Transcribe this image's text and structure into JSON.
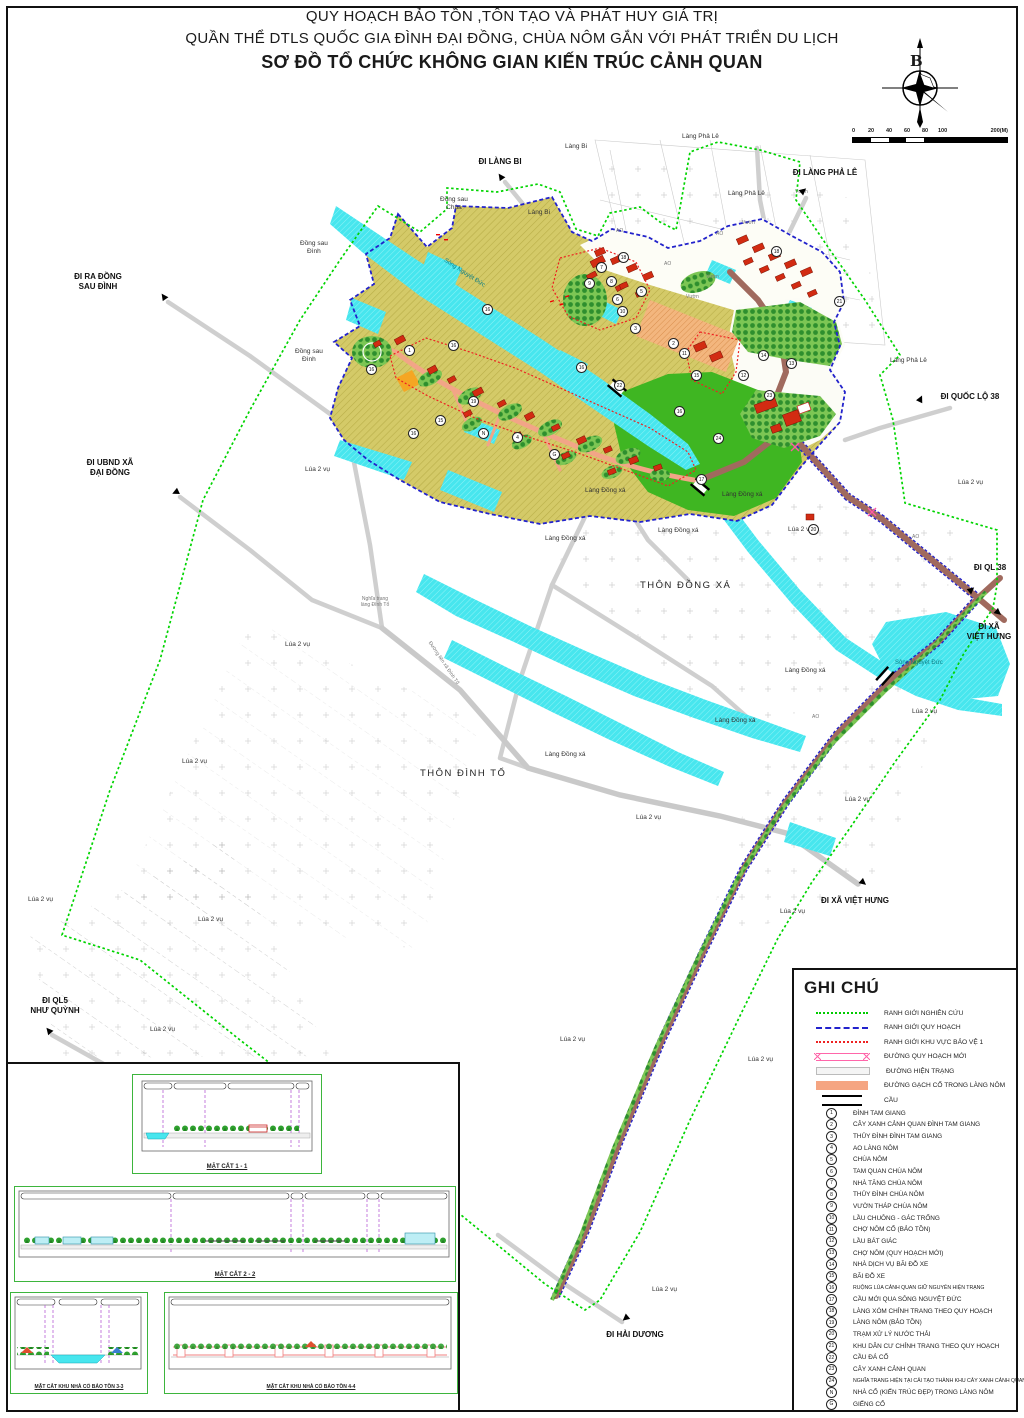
{
  "title": {
    "line1": "QUY HOẠCH BẢO TỒN ,TÔN TẠO VÀ PHÁT HUY GIÁ TRỊ",
    "line2": "QUẦN THỂ DTLS QUỐC GIA ĐÌNH ĐẠI ĐỒNG, CHÙA NÔM GẮN VỚI PHÁT TRIỂN DU LỊCH",
    "line3": "SƠ ĐỒ TỔ CHỨC KHÔNG GIAN KIẾN TRÚC CẢNH QUAN"
  },
  "compass": {
    "north_label": "B"
  },
  "scalebar": {
    "ticks": [
      "0",
      "20",
      "40",
      "60",
      "80",
      "100"
    ],
    "end_label": "200(M)"
  },
  "legend": {
    "title": "GHI CHÚ",
    "line_items": [
      {
        "label": "RANH GIỚI NGHIÊN CỨU"
      },
      {
        "label": "RANH GIỚI QUY HOẠCH"
      },
      {
        "label": "RANH GIỚI KHU VỰC BẢO VỆ 1"
      },
      {
        "label": "ĐƯỜNG QUY HOẠCH MỚI"
      },
      {
        "label": "ĐƯỜNG HIỆN TRẠNG"
      },
      {
        "label": "ĐƯỜNG GẠCH CỔ TRONG LÀNG NÔM"
      },
      {
        "label": "CẦU"
      }
    ],
    "numbered_items": [
      {
        "key": "1",
        "label": "ĐÌNH TAM GIANG"
      },
      {
        "key": "2",
        "label": "CÂY XANH CẢNH QUAN ĐÌNH TAM GIANG"
      },
      {
        "key": "3",
        "label": "THỦY ĐÌNH ĐÌNH TAM GIANG"
      },
      {
        "key": "4",
        "label": "AO LÀNG NÔM"
      },
      {
        "key": "5",
        "label": "CHÙA NÔM"
      },
      {
        "key": "6",
        "label": "TAM QUAN CHÙA NÔM"
      },
      {
        "key": "7",
        "label": "NHÀ TĂNG CHÙA NÔM"
      },
      {
        "key": "8",
        "label": "THỦY ĐÌNH CHÙA NÔM"
      },
      {
        "key": "9",
        "label": "VƯỜN THÁP CHÙA NÔM"
      },
      {
        "key": "10",
        "label": "LẦU CHUÔNG - GÁC TRỐNG"
      },
      {
        "key": "11",
        "label": "CHỢ NÔM CỔ (BẢO TỒN)"
      },
      {
        "key": "12",
        "label": "LẦU BÁT GIÁC"
      },
      {
        "key": "13",
        "label": "CHỢ NÔM (QUY HOẠCH MỚI)"
      },
      {
        "key": "14",
        "label": "NHÀ DỊCH VỤ BÃI ĐỖ XE"
      },
      {
        "key": "15",
        "label": "BÃI ĐỖ XE"
      },
      {
        "key": "16",
        "label": "RUỘNG LÚA CẢNH QUAN GIỮ NGUYÊN HIỆN TRẠNG"
      },
      {
        "key": "17",
        "label": "CẦU MỚI QUA SÔNG NGUYỆT ĐỨC"
      },
      {
        "key": "18",
        "label": "LÀNG XÓM CHỈNH TRANG THEO QUY HOẠCH"
      },
      {
        "key": "19",
        "label": "LÀNG NÔM (BẢO TỒN)"
      },
      {
        "key": "20",
        "label": "TRẠM XỬ LÝ NƯỚC THẢI"
      },
      {
        "key": "21",
        "label": "KHU DÂN CƯ CHỈNH TRANG THEO QUY HOẠCH"
      },
      {
        "key": "22",
        "label": "CẦU ĐÁ CỔ"
      },
      {
        "key": "23",
        "label": "CÂY XANH CẢNH QUAN"
      },
      {
        "key": "24",
        "label": "NGHĨA TRANG HIỆN TẠI CẢI TẠO THÀNH KHU CÂY XANH CẢNH QUAN"
      },
      {
        "key": "N",
        "label": "NHÀ CỔ (KIẾN TRÚC ĐẸP) TRONG LÀNG NÔM"
      },
      {
        "key": "G",
        "label": "GIẾNG CỔ"
      }
    ]
  },
  "sections": {
    "s1": "MẶT CẮT 1 - 1",
    "s2": "MẶT CẮT 2 - 2",
    "s3": "MẶT CẮT KHU NHÀ CỔ BẢO TỒN 3-3",
    "s4": "MẶT CẮT KHU NHÀ CỔ BẢO TỒN 4-4"
  },
  "map": {
    "colors": {
      "research_boundary": "#00d400",
      "planning_boundary": "#2222cc",
      "protection_boundary": "#ee2222",
      "water": "#47e6ee",
      "rice_field": "#d2c763",
      "new_road": "#a06a5e",
      "brick_road": "#f2a587",
      "green_field": "#3fb622"
    },
    "labels": [
      {
        "text": "ĐI LÀNG BI"
      },
      {
        "text": "ĐI LÀNG PHẢ LÊ"
      },
      {
        "text": "ĐI RA ĐỒNG\nSAU ĐÌNH"
      },
      {
        "text": "ĐI UBND XÃ\nĐẠI ĐỒNG"
      },
      {
        "text": "ĐI QUỐC LỘ 38"
      },
      {
        "text": "ĐI QL 38"
      },
      {
        "text": "ĐI XÃ\nVIỆT HƯNG"
      },
      {
        "text": "ĐI XÃ VIỆT HƯNG"
      },
      {
        "text": "ĐI QL5\nNHƯ QUỲNH"
      },
      {
        "text": "ĐI HẢI DƯƠNG"
      },
      {
        "text": "Làng Bi"
      },
      {
        "text": "Làng Phả Lê"
      },
      {
        "text": "Làng Phả Lê"
      },
      {
        "text": "Vườn"
      },
      {
        "text": "Đồng sau\nChùa"
      },
      {
        "text": "Làng Bi"
      },
      {
        "text": "Đồng sau\nĐình"
      },
      {
        "text": "Đồng sau\nĐình"
      },
      {
        "text": "Làng Phả Lê"
      },
      {
        "text": "AO"
      },
      {
        "text": "AO"
      },
      {
        "text": "AO"
      },
      {
        "text": "Vườn"
      },
      {
        "text": "Vườn"
      },
      {
        "text": "Vườn"
      },
      {
        "text": "Làng Đồng xá"
      },
      {
        "text": "Làng Đồng xá"
      },
      {
        "text": "Làng Đồng xá"
      },
      {
        "text": "Làng Đồng xá"
      },
      {
        "text": "Làng Đồng xá"
      },
      {
        "text": "Làng Đồng xá"
      },
      {
        "text": "Làng Đồng xá"
      },
      {
        "text": "THÔN ĐỒNG XÁ"
      },
      {
        "text": "THÔN ĐÌNH TỔ"
      },
      {
        "text": "Sông Nguyệt Đức"
      },
      {
        "text": "Sông Nguyệt Đức"
      },
      {
        "text": "Nghĩa trang\nlàng Đình Tổ"
      },
      {
        "text": "AO"
      },
      {
        "text": "AO"
      },
      {
        "text": "Lúa 2 vụ"
      },
      {
        "text": "Lúa 2 vụ"
      },
      {
        "text": "Lúa 2 vụ"
      },
      {
        "text": "Lúa 2 vụ"
      },
      {
        "text": "Lúa 2 vụ"
      },
      {
        "text": "Lúa 2 vụ"
      },
      {
        "text": "Lúa 2 vụ"
      },
      {
        "text": "Lúa 2 vụ"
      },
      {
        "text": "Lúa 2 vụ"
      },
      {
        "text": "Lúa 2 vụ"
      },
      {
        "text": "Lúa 2 vụ"
      },
      {
        "text": "Lúa 2 vụ"
      },
      {
        "text": "Lúa 2 vụ"
      },
      {
        "text": "Lúa 2 vụ"
      },
      {
        "text": "Lúa 2 vụ"
      },
      {
        "text": "Đường liên xã Đình Tổ"
      }
    ],
    "markers": [
      "16",
      "1",
      "16",
      "16",
      "19",
      "N",
      "G",
      "4",
      "15",
      "16",
      "7",
      "8",
      "9",
      "5",
      "6",
      "10",
      "3",
      "2",
      "11",
      "23",
      "12",
      "14",
      "13",
      "15",
      "21",
      "16",
      "24",
      "22",
      "17",
      "18",
      "20",
      "16",
      "18"
    ]
  }
}
